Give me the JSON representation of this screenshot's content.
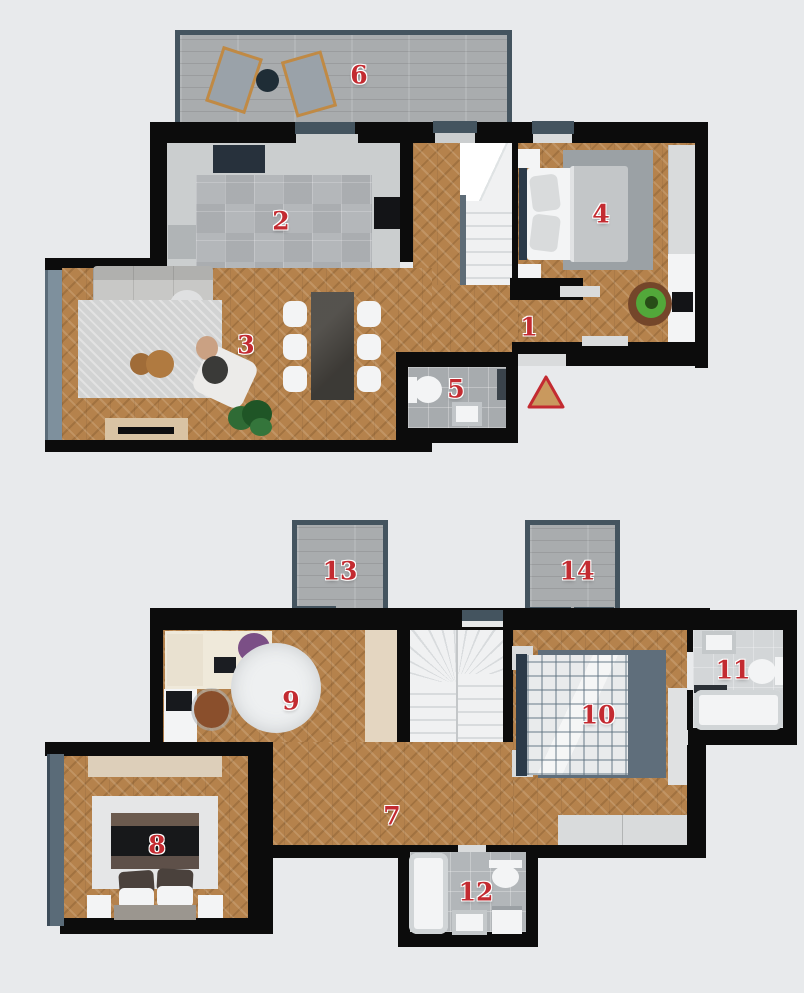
{
  "meta": {
    "description": "Top-down 3D render of a two-storey apartment floor plan with numbered rooms",
    "floors_shown": 2
  },
  "palette": {
    "bg": "#e8eaec",
    "wall": "#0c0c0c",
    "wood": "#b5824c",
    "plank": "#a9acae",
    "frame": "#44545f",
    "glass": "#7e909d",
    "glass_dark": "#5a6b78",
    "tile_kitchen": "#b4b7ba",
    "tile_bath5": "#a7abae",
    "tile_bath11": "#d3d6d8",
    "tile_bath12": "#b2b6b9",
    "counter": "#cbcecf",
    "fixture": "#f3f4f5",
    "lgray": "#d9dbdc",
    "sink_dark": "#27313c",
    "cooktop": "#131417",
    "sofa": "#c8c8c6",
    "rug_living": "#d2d3d3",
    "rug_bed4": "#9ba1a5",
    "rug_bed10": "#5f6e7b",
    "rug_bed8": "#e5e6e7",
    "rug_round": "#eef0f1",
    "table_dark": "#47443f",
    "wood_warm": "#a06c38",
    "console_tan": "#d9c3a4",
    "wardrobe_tan": "#e4d6c1",
    "plant": "#2f6b35",
    "accent": "#c32b31",
    "tri_fill": "#c9995e",
    "stairs": "#f0f1f2",
    "tread": "#d8dbdd",
    "headboard": "#2b3a49",
    "blanket4": "#c3c6c8",
    "bed8_dark": "#17181a",
    "bed8_brown": "#5e5049",
    "person_green": "#52a83a",
    "person_purple": "#7b4f86",
    "chair_brown": "#8a4f2c",
    "denim": "#4a6a8a"
  },
  "labels": [
    {
      "number": "1",
      "room": "hallway",
      "floor": "upper"
    },
    {
      "number": "2",
      "room": "kitchen",
      "floor": "upper"
    },
    {
      "number": "3",
      "room": "living-dining",
      "floor": "upper"
    },
    {
      "number": "4",
      "room": "bedroom",
      "floor": "upper"
    },
    {
      "number": "5",
      "room": "toilet",
      "floor": "upper"
    },
    {
      "number": "6",
      "room": "terrace",
      "floor": "upper"
    },
    {
      "number": "7",
      "room": "hallway",
      "floor": "lower"
    },
    {
      "number": "8",
      "room": "bedroom",
      "floor": "lower"
    },
    {
      "number": "9",
      "room": "bedroom-office",
      "floor": "lower"
    },
    {
      "number": "10",
      "room": "bedroom",
      "floor": "lower"
    },
    {
      "number": "11",
      "room": "bathroom",
      "floor": "lower"
    },
    {
      "number": "12",
      "room": "bathroom",
      "floor": "lower"
    },
    {
      "number": "13",
      "room": "balcony",
      "floor": "lower"
    },
    {
      "number": "14",
      "room": "balcony",
      "floor": "lower"
    }
  ],
  "entrance_marker": {
    "shape": "triangle"
  }
}
